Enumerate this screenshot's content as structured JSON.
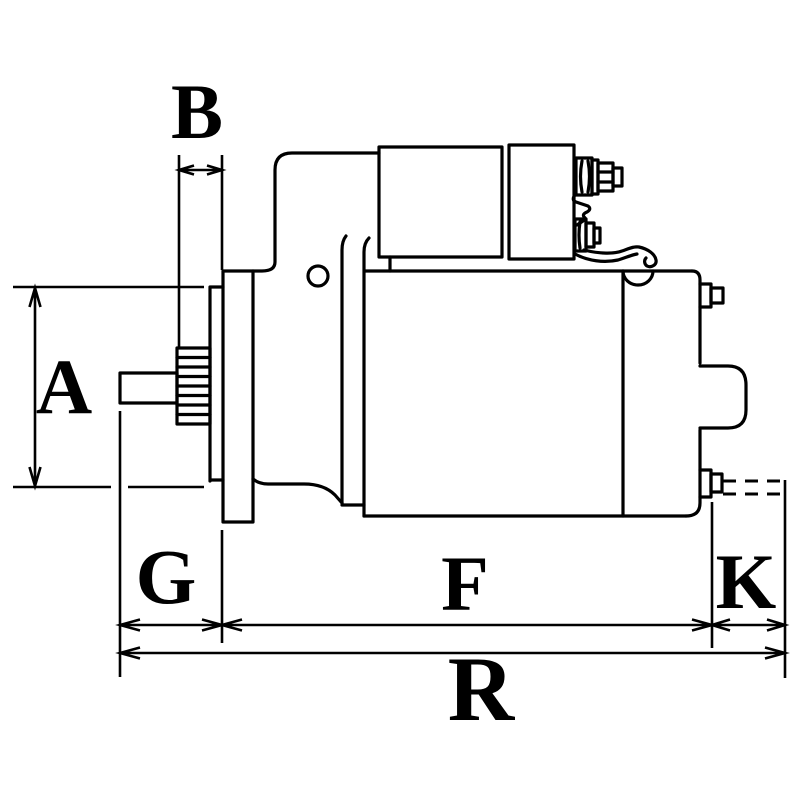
{
  "drawing": {
    "background_color": "#ffffff",
    "line_color": "#000000",
    "labels": {
      "a": "A",
      "b": "B",
      "g": "G",
      "f": "F",
      "k": "K",
      "r": "R"
    }
  }
}
